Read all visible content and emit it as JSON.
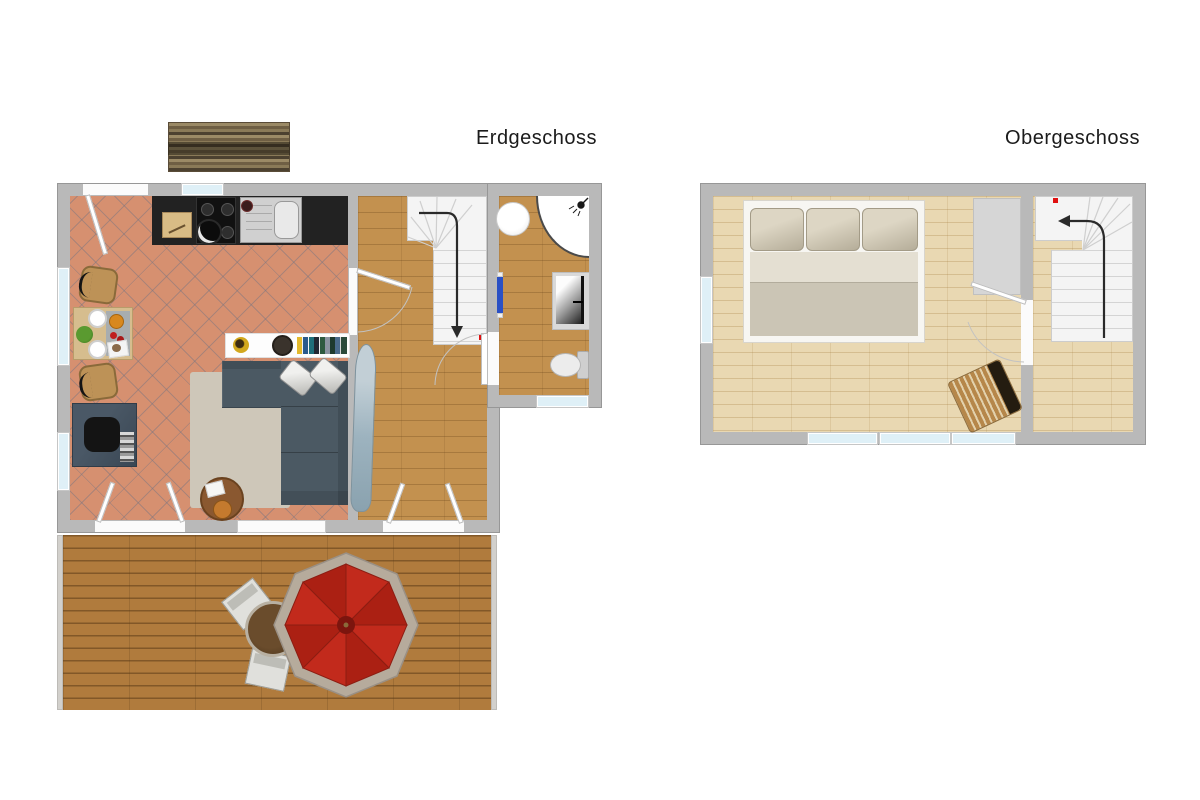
{
  "labels": {
    "ground_floor": "Erdgeschoss",
    "upper_floor": "Obergeschoss"
  },
  "palette": {
    "wall_gray": "#b9b9b9",
    "tile_terracotta": "#d69070",
    "wood_medium": "#c3914f",
    "wood_light": "#e9d8b2",
    "deck_brown": "#b07b3d",
    "sofa_blue_gray": "#4b5963",
    "rug_beige": "#cec7b9",
    "desk_slate": "#42505c",
    "umbrella_red": "#c22a1c",
    "umbrella_rim": "#b6ab9c",
    "bed_beige": "#cbc4b4",
    "stairs_white": "#f4f4f4",
    "window_blue": "#dff0f7",
    "radiator_blue": "#2a50c4",
    "marker_red": "#e01010",
    "counter_black": "#222222"
  },
  "ground_floor": {
    "label": "Erdgeschoss",
    "rooms": [
      "open kitchen and living room",
      "hallway with staircase",
      "bathroom"
    ],
    "items": [
      "garden-bench",
      "entry-door",
      "kitchen-counter",
      "cutting-board",
      "gas-hob",
      "cooking-pot",
      "kitchen-sink",
      "dining-table",
      "dining-chair",
      "salad-bowl",
      "plates",
      "serving-tray",
      "desk",
      "desk-chair",
      "sideboard-shelf",
      "decorative-plate",
      "wall-clock",
      "book-row",
      "corner-sofa",
      "sofa-cushions",
      "rug",
      "coffee-table",
      "ironing-board",
      "staircase-down",
      "washbasin",
      "corner-shower",
      "shower-head",
      "washing-machine",
      "toilet",
      "towel-radiator",
      "french-doors-living",
      "french-doors-hall",
      "bathroom-door"
    ]
  },
  "upper_floor": {
    "label": "Obergeschoss",
    "rooms": [
      "bedroom",
      "stair hall"
    ],
    "items": [
      "double-bed",
      "bed-pillows",
      "wardrobe",
      "lounge-chair",
      "bedroom-door",
      "staircase-up",
      "windows"
    ]
  },
  "terrace": {
    "items": [
      "wood-deck",
      "garden-table",
      "garden-chair",
      "parasol-red"
    ]
  }
}
